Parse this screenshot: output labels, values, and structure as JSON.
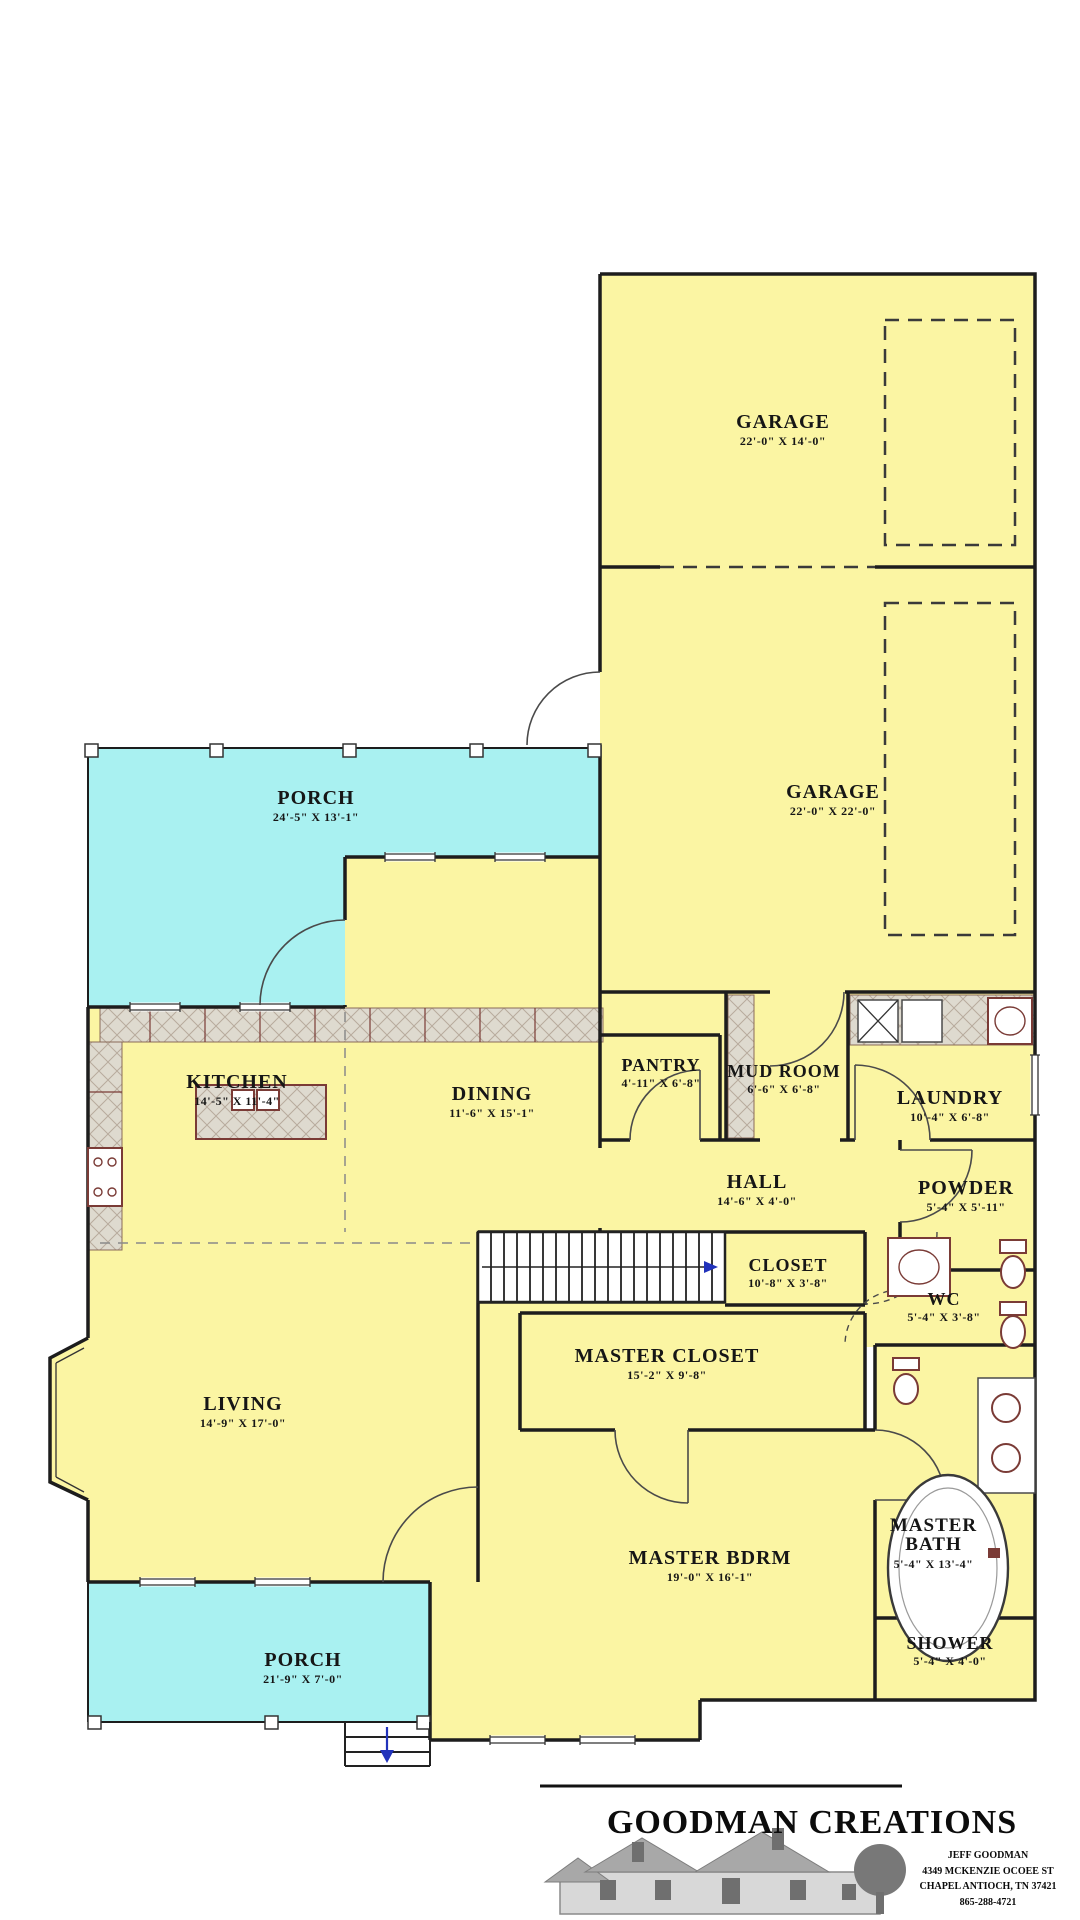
{
  "colors": {
    "room_fill": "#FBF5A3",
    "porch_fill": "#A9F1F1",
    "wall": "#1d1d1d",
    "fixture": "#7a3b36",
    "tile_fill": "#DEDACF",
    "tile_line": "#b7ab9d",
    "accent_blue": "#2233bb",
    "background": "#ffffff"
  },
  "rooms": [
    {
      "id": "garage-1",
      "label": "GARAGE",
      "dims": "22'-0\" X 14'-0\""
    },
    {
      "id": "garage-2",
      "label": "GARAGE",
      "dims": "22'-0\" X 22'-0\""
    },
    {
      "id": "porch-upper",
      "label": "PORCH",
      "dims": "24'-5\" X 13'-1\""
    },
    {
      "id": "kitchen",
      "label": "KITCHEN",
      "dims": "14'-5\" X 11'-4\""
    },
    {
      "id": "dining",
      "label": "DINING",
      "dims": "11'-6\" X 15'-1\""
    },
    {
      "id": "pantry",
      "label": "PANTRY",
      "dims": "4'-11\" X 6'-8\""
    },
    {
      "id": "mud-room",
      "label": "MUD ROOM",
      "dims": "6'-6\" X 6'-8\""
    },
    {
      "id": "laundry",
      "label": "LAUNDRY",
      "dims": "10'-4\" X 6'-8\""
    },
    {
      "id": "hall",
      "label": "HALL",
      "dims": "14'-6\" X 4'-0\""
    },
    {
      "id": "powder",
      "label": "POWDER",
      "dims": "5'-4\" X 5'-11\""
    },
    {
      "id": "closet",
      "label": "CLOSET",
      "dims": "10'-8\" X 3'-8\""
    },
    {
      "id": "wc",
      "label": "WC",
      "dims": "5'-4\" X 3'-8\""
    },
    {
      "id": "master-closet",
      "label": "MASTER CLOSET",
      "dims": "15'-2\" X 9'-8\""
    },
    {
      "id": "living",
      "label": "LIVING",
      "dims": "14'-9\" X 17'-0\""
    },
    {
      "id": "master-bdrm",
      "label": "MASTER BDRM",
      "dims": "19'-0\" X 16'-1\""
    },
    {
      "id": "master-bath",
      "label": "MASTER BATH",
      "dims": "5'-4\" X 13'-4\""
    },
    {
      "id": "shower",
      "label": "SHOWER",
      "dims": "5'-4\" X 4'-0\""
    },
    {
      "id": "porch-lower",
      "label": "PORCH",
      "dims": "21'-9\" X 7'-0\""
    }
  ],
  "logo": {
    "company": "GOODMAN CREATIONS",
    "address_lines": [
      "JEFF GOODMAN",
      "4349 MCKENZIE OCOEE ST",
      "CHAPEL ANTIOCH, TN 37421",
      "865-288-4721"
    ]
  }
}
